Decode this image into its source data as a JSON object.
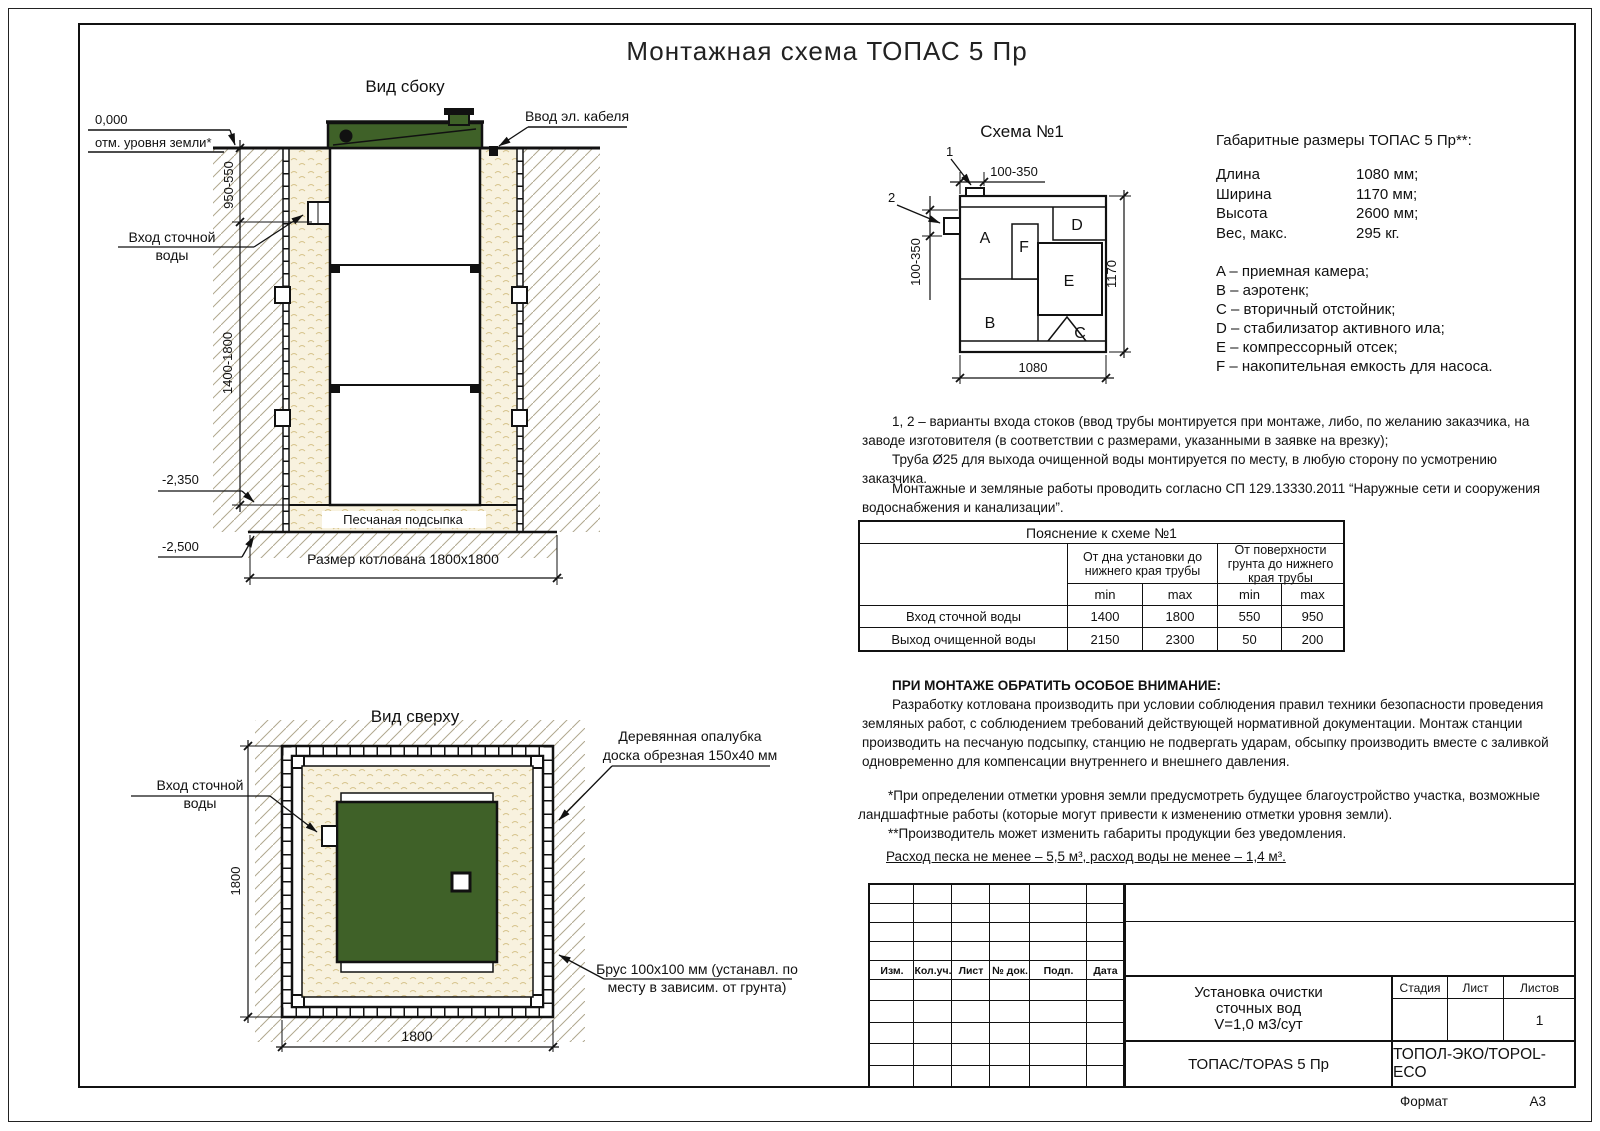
{
  "page": {
    "title": "Монтажная схема ТОПАС 5 Пр",
    "format_label": "Формат",
    "format_value": "А3"
  },
  "colors": {
    "green": "#3f6128",
    "sand": "#f8f2df",
    "sand_stroke": "#d6c38b",
    "hatch": "#b0a78e",
    "line": "#111111"
  },
  "side_view": {
    "title": "Вид сбоку",
    "zero_mark": "0,000",
    "zero_label": "отм. уровня земли*",
    "cable_label": "Ввод эл. кабеля",
    "inlet_l1": "Вход сточной",
    "inlet_l2": "воды",
    "dim_upper": "950-550",
    "dim_lower": "1400-1800",
    "lvl_sand": "-2,350",
    "lvl_bottom": "-2,500",
    "sand_label": "Песчаная подсыпка",
    "pit_dim": "Размер котлована 1800х1800"
  },
  "top_view": {
    "title": "Вид сверху",
    "inlet_l1": "Вход сточной",
    "inlet_l2": "воды",
    "formwork_l1": "Деревянная опалубка",
    "formwork_l2": "доска обрезная 150х40 мм",
    "beam_l1": "Брус 100х100 мм (устанавл. по",
    "beam_l2": "месту в зависим. от грунта)",
    "dim_left": "1800",
    "dim_bottom": "1800"
  },
  "schema": {
    "title": "Схема №1",
    "m1": "1",
    "m2": "2",
    "dim_top": "100-350",
    "dim_left": "100-350",
    "dim_bottom": "1080",
    "dim_right": "1170",
    "a": "A",
    "b": "B",
    "c": "C",
    "d": "D",
    "e": "E",
    "f": "F"
  },
  "specs": {
    "title": "Габаритные размеры ТОПАС 5 Пр**:",
    "rows": [
      {
        "label": "Длина",
        "value": "1080 мм;"
      },
      {
        "label": "Ширина",
        "value": "1170 мм;"
      },
      {
        "label": "Высота",
        "value": "2600 мм;"
      },
      {
        "label": "Вес, макс.",
        "value": "295 кг."
      }
    ]
  },
  "legend": {
    "items": [
      "A – приемная камера;",
      "B – аэротенк;",
      "C – вторичный отстойник;",
      "D – стабилизатор активного ила;",
      "E – компрессорный отсек;",
      "F – накопительная емкость для насоса."
    ]
  },
  "notes": {
    "p1a": "1, 2 – варианты входа стоков (ввод трубы монтируется при монтаже, либо, по желанию заказчика, на заводе изготовителя (в соответствии с размерами, указанными в заявке на врезку);",
    "p1b": "Труба Ø25 для выхода очищенной воды монтируется по месту, в любую сторону по усмотрению заказчика.",
    "p2": "Монтажные и земляные работы проводить согласно СП 129.13330.2011 “Наружные сети и сооружения водоснабжения и канализации”."
  },
  "table": {
    "title": "Пояснение к схеме №1",
    "g1": "От дна установки до нижнего края трубы",
    "g2": "От поверхности грунта до нижнего края трубы",
    "min": "min",
    "max": "max",
    "rows": [
      {
        "label": "Вход сточной воды",
        "v": [
          "1400",
          "1800",
          "550",
          "950"
        ]
      },
      {
        "label": "Выход очищенной воды",
        "v": [
          "2150",
          "2300",
          "50",
          "200"
        ]
      }
    ]
  },
  "attention": {
    "heading": "ПРИ МОНТАЖЕ ОБРАТИТЬ ОСОБОЕ ВНИМАНИЕ:",
    "body": "Разработку котлована производить при условии соблюдения правил техники безопасности проведения земляных работ, с соблюдением требований действующей нормативной документации. Монтаж станции производить на песчаную подсыпку, станцию не подвергать ударам, обсыпку производить вместе с заливкой одновременно для компенсации внутреннего и внешнего давления."
  },
  "footnotes": {
    "s1": "*При определении отметки уровня земли предусмотреть будущее благоустройство участка, возможные ландшафтные работы (которые могут привести к изменению отметки уровня земли).",
    "s2": "**Производитель может изменить габариты продукции без уведомления."
  },
  "consumption": "Расход песка не менее – 5,5 м³, расход воды не менее – 1,4 м³.",
  "stamp": {
    "cols": [
      "Изм.",
      "Кол.уч.",
      "Лист",
      "№ док.",
      "Подп.",
      "Дата"
    ],
    "title_l1": "Установка очистки",
    "title_l2": "сточных вод",
    "title_l3": "V=1,0 м3/сут",
    "stage": "Стадия",
    "sheet": "Лист",
    "sheets": "Листов",
    "sheets_value": "1",
    "model": "ТОПАС/TOPAS 5 Пр",
    "company": "ТОПОЛ-ЭКО/TOPOL-ECO"
  }
}
